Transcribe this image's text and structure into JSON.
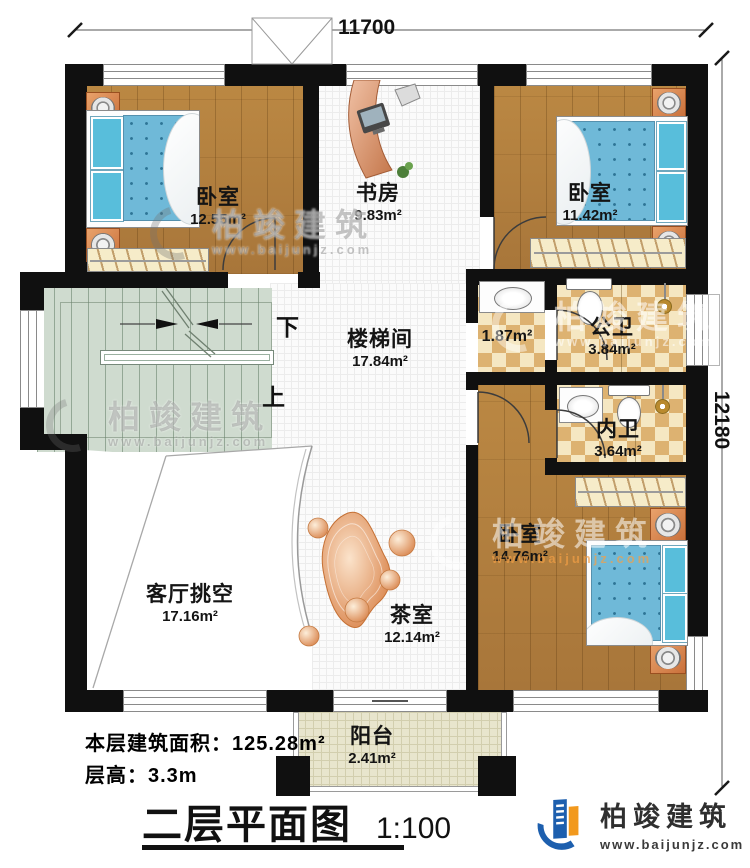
{
  "plan": {
    "dimensions": {
      "top_width": "11700",
      "right_height": "12180"
    },
    "stairs": {
      "down_label": "下",
      "up_label": "上"
    },
    "rooms": {
      "bedroom_top_left": {
        "name": "卧室",
        "area": "12.55m²"
      },
      "study": {
        "name": "书房",
        "area": "9.83m²"
      },
      "bedroom_top_right": {
        "name": "卧室",
        "area": "11.42m²"
      },
      "stairwell": {
        "name": "楼梯间",
        "area": "17.84m²"
      },
      "bath_lobby": {
        "area": "1.87m²"
      },
      "public_bath": {
        "name": "公卫",
        "area": "3.84m²"
      },
      "ensuite_bath": {
        "name": "内卫",
        "area": "3.64m²"
      },
      "bedroom_bottom": {
        "name": "卧室",
        "area": "14.76m²"
      },
      "living_room_void": {
        "name": "客厅挑空",
        "area": "17.16m²"
      },
      "tea_room": {
        "name": "茶室",
        "area": "12.14m²"
      },
      "balcony": {
        "name": "阳台",
        "area": "2.41m²"
      }
    }
  },
  "footer": {
    "floor_area_label": "本层建筑面积：",
    "floor_area_value": "125.28m²",
    "floor_height_label": "层高：",
    "floor_height_value": "3.3m"
  },
  "title_block": {
    "title": "二层平面图",
    "scale": "1:100"
  },
  "brand": {
    "name": "柏竣建筑",
    "url": "www.baijunjz.com"
  },
  "colors": {
    "wall": "#101010",
    "wood_floor": "#b5823f",
    "bath_tile": "#ddb271",
    "stair": "#cfdbcf",
    "bed": "#6fb9d8",
    "accent_orange": "#f2991d",
    "brand_blue": "#1d5fae"
  }
}
